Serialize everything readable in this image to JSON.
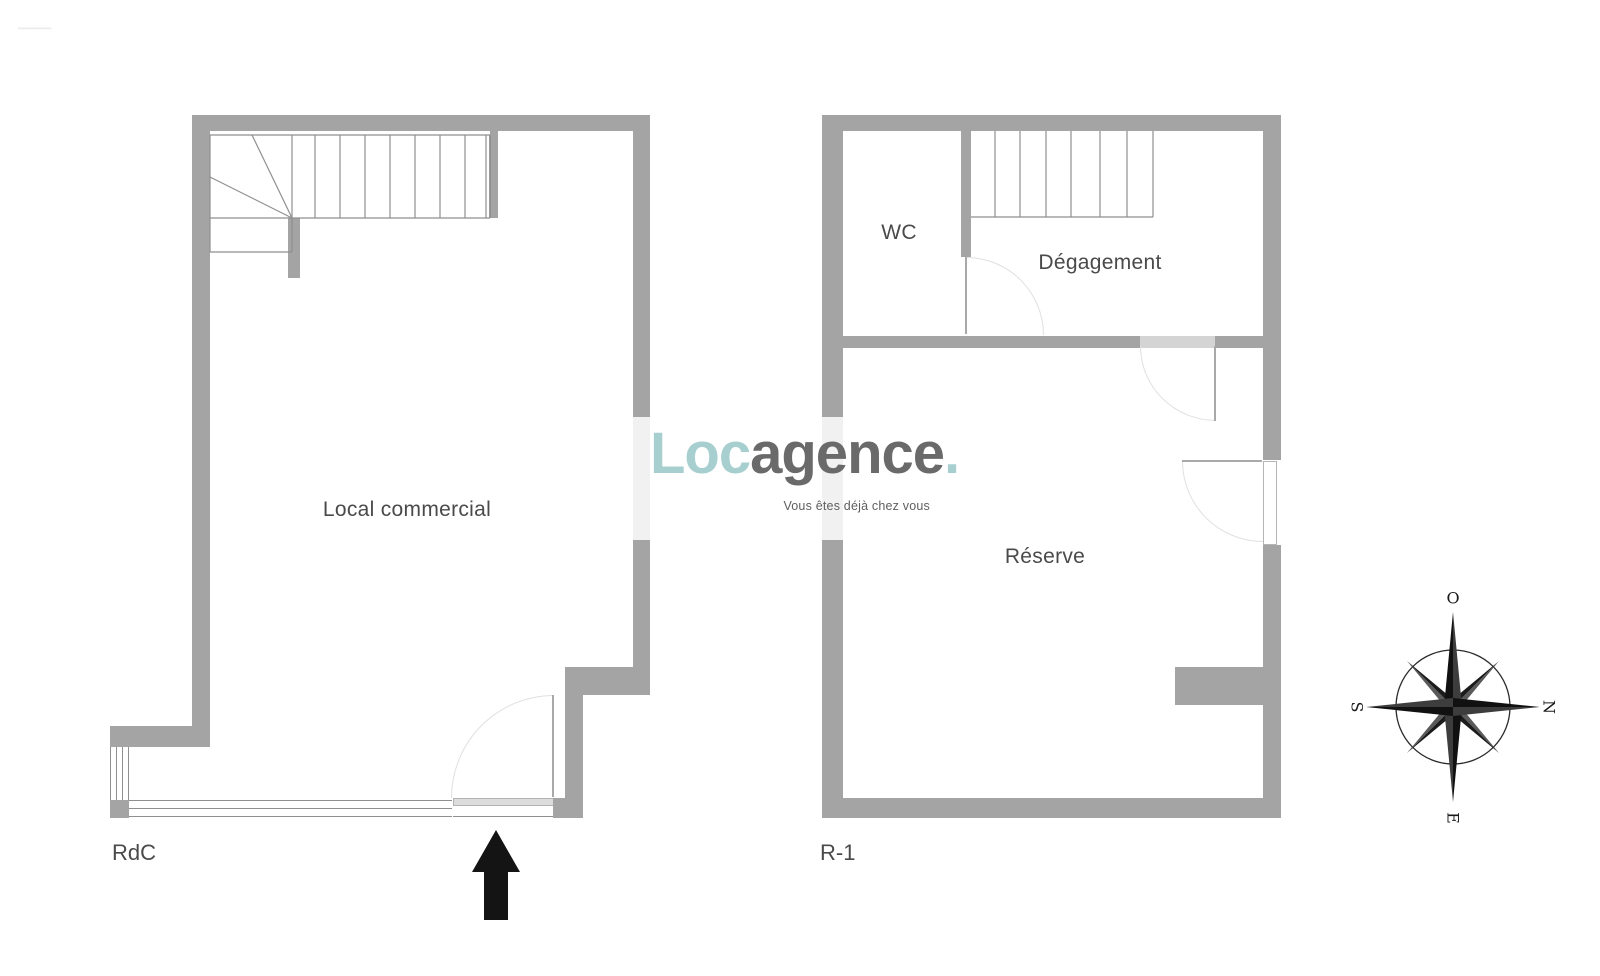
{
  "watermark": "····················",
  "logo": {
    "loc": "Loc",
    "agence": "agence",
    "dot": ".",
    "tagline": "Vous êtes déjà chez vous"
  },
  "plans": {
    "rdc": {
      "floor_label": "RdC",
      "room_label": "Local commercial"
    },
    "r1": {
      "floor_label": "R-1",
      "rooms": {
        "wc": "WC",
        "degagement": "Dégagement",
        "reserve": "Réserve"
      }
    }
  },
  "compass": {
    "top": "O",
    "right": "N",
    "bottom": "E",
    "left": "S"
  },
  "colors": {
    "wall": "#a4a4a4",
    "wall_light": "#d4d4d4",
    "line": "#8f8f8f",
    "arc": "#e0e0e0",
    "text": "#4a4a4a",
    "arrow": "#141414",
    "logo_teal": "#a7cfcf",
    "logo_gray": "#6a6a6a"
  }
}
